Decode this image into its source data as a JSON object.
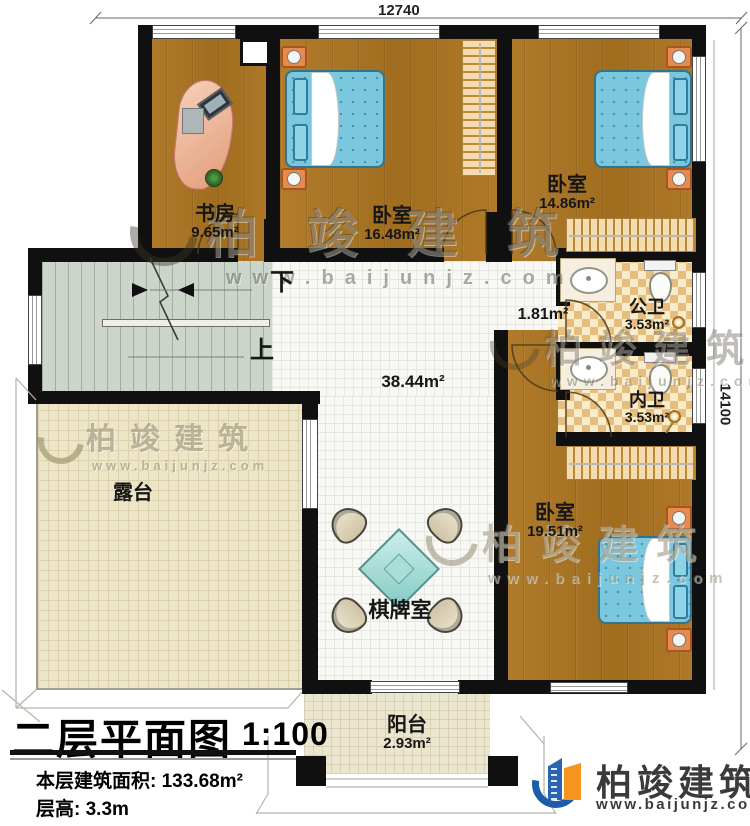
{
  "dimensions": {
    "top": "12740",
    "right": "14100"
  },
  "rooms": {
    "study": {
      "name": "书房",
      "area": "9.65m²"
    },
    "bedroom_mid": {
      "name": "卧室",
      "area": "16.48m²"
    },
    "bedroom_right": {
      "name": "卧室",
      "area": "14.86m²"
    },
    "bath_public": {
      "name": "公卫",
      "area": "3.53m²"
    },
    "bath_private": {
      "name": "内卫",
      "area": "3.53m²"
    },
    "bedroom_master": {
      "name": "卧室",
      "area": "19.51m²"
    },
    "hall": {
      "area": "38.44m²"
    },
    "nook": {
      "area": "1.81m²"
    },
    "terrace": {
      "name": "露台"
    },
    "game_room": {
      "name": "棋牌室"
    },
    "balcony": {
      "name": "阳台",
      "area": "2.93m²"
    }
  },
  "stairs": {
    "down": "下",
    "up": "上"
  },
  "title_block": {
    "title": "二层平面图",
    "scale": "1:100",
    "floor_area_label": "本层建筑面积:",
    "floor_area_value": "133.68m²",
    "floor_height_label": "层高:",
    "floor_height_value": "3.3m"
  },
  "branding": {
    "company": "柏竣建筑",
    "website": "www.baijunjz.com"
  },
  "watermark": {
    "company": "柏竣建筑",
    "website": "www.baijunjz.com"
  },
  "colors": {
    "wall": "#101010",
    "wood": "#aa7423",
    "bed_blue": "#7ac7de",
    "stairs_green": "#cbd5ca",
    "terrace_cream": "#ece5c8",
    "checker_tan": "#e5bd7c",
    "logo_blue": "#1d5ca8",
    "logo_orange": "#f7941e"
  }
}
